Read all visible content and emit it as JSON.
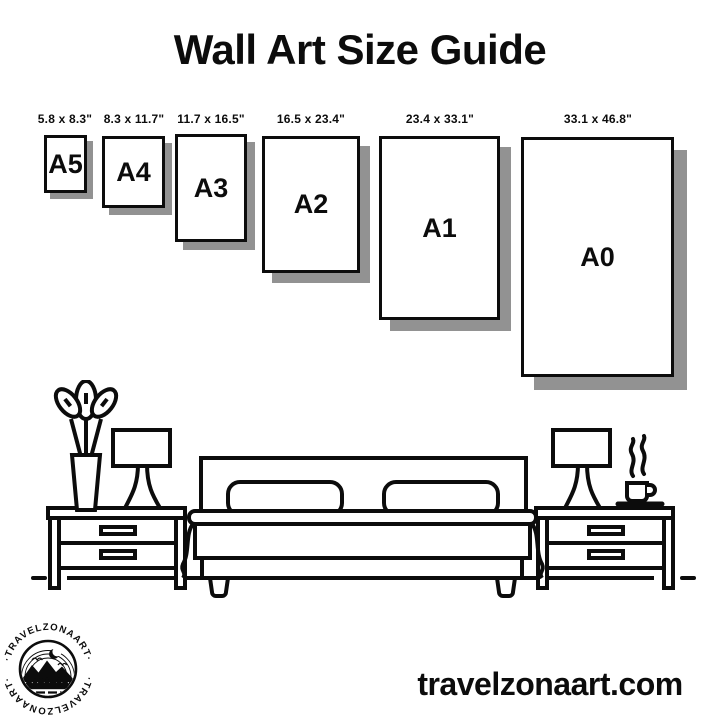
{
  "title": "Wall Art Size Guide",
  "frames": [
    {
      "name": "A5",
      "dimensions": "5.8 x 8.3\""
    },
    {
      "name": "A4",
      "dimensions": "8.3 x 11.7\""
    },
    {
      "name": "A3",
      "dimensions": "11.7 x 16.5\""
    },
    {
      "name": "A2",
      "dimensions": "16.5 x 23.4\""
    },
    {
      "name": "A1",
      "dimensions": "23.4 x 33.1\""
    },
    {
      "name": "A0",
      "dimensions": "33.1 x 46.8\""
    }
  ],
  "logo": {
    "arc_text_top": "·TRAVELZONAART·",
    "arc_text_bottom": "·TRAVELZONAART·"
  },
  "footer": {
    "website": "travelzonaart.com"
  },
  "illustration": {
    "items": [
      "plant",
      "table-lamp-left",
      "nightstand-left",
      "bed",
      "nightstand-right",
      "table-lamp-right",
      "coffee-cup",
      "steam",
      "floor-line"
    ]
  },
  "colors": {
    "ink": "#0c0c0c",
    "shadow": "#929292",
    "background": "#ffffff"
  }
}
